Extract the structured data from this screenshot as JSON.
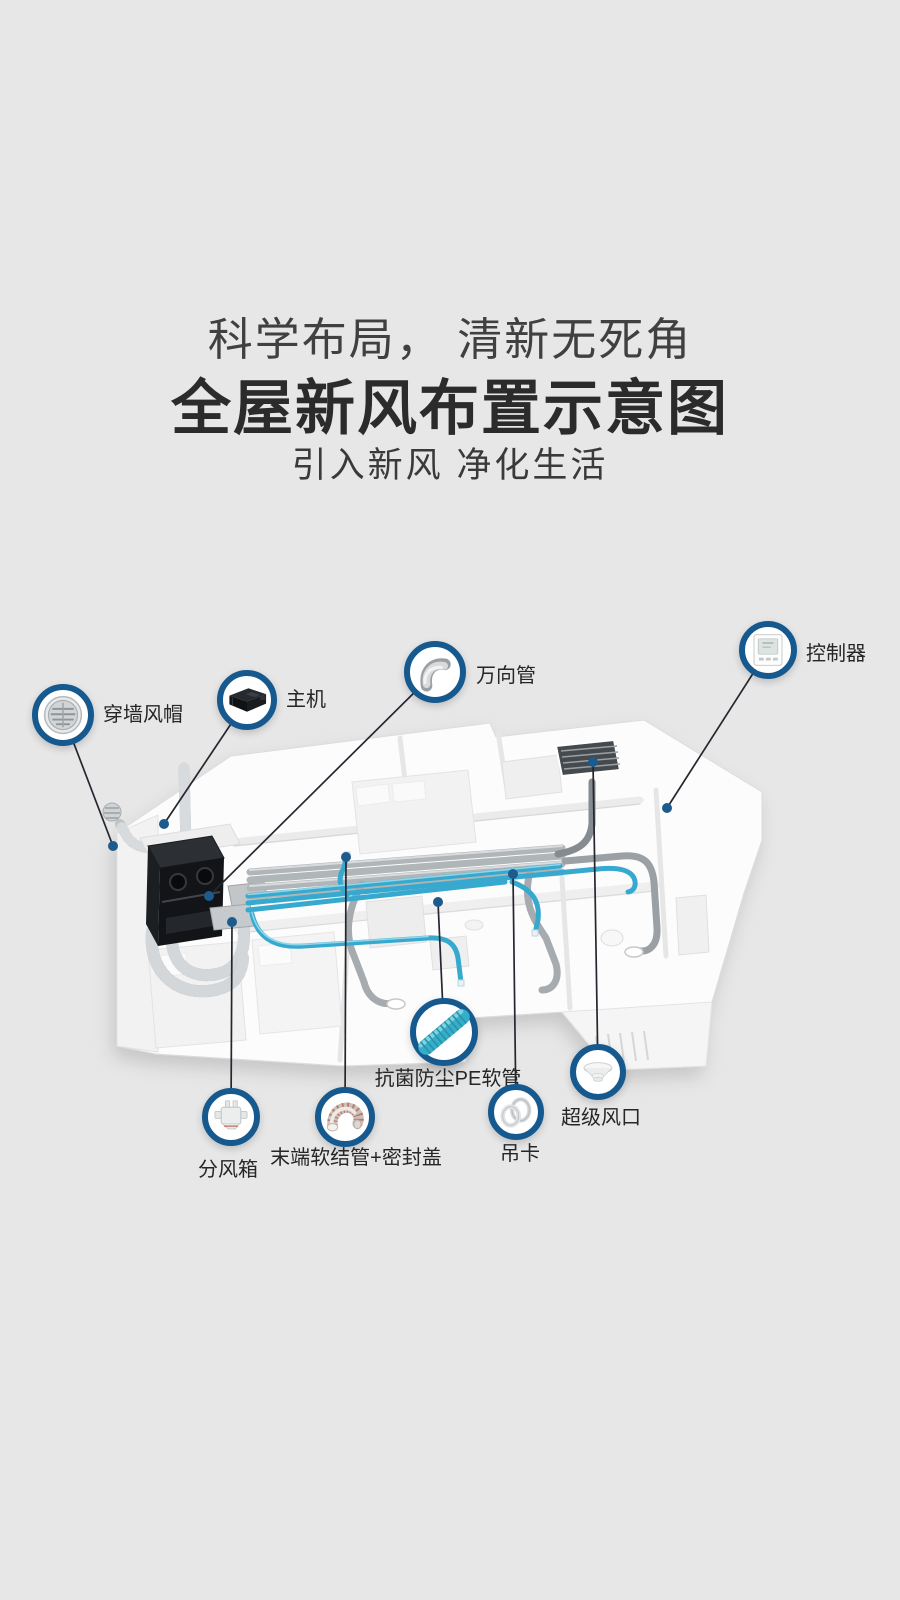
{
  "page": {
    "width": 900,
    "height": 1600,
    "background": "#e7e7e7"
  },
  "header": {
    "tagline": "科学布局， 清新无死角",
    "title": "全屋新风布置示意图",
    "subtitle": "引入新风  净化生活"
  },
  "colors": {
    "accent_blue": "#15598f",
    "leader_dot_blue": "#1d5b8d",
    "pipe_blue": "#38a9ce",
    "duct_gray": "#b0b5b8",
    "text_dark": "#2f2f2f",
    "background": "#e7e7e7"
  },
  "diagram": {
    "callouts": [
      {
        "id": "wall-cap",
        "label": "穿墙风帽",
        "icon": "wall-vent-cap-icon",
        "cx": 63,
        "cy": 715,
        "r": 31,
        "dot": [
          113,
          846
        ],
        "label_x": 103,
        "label_y": 715,
        "align": "left"
      },
      {
        "id": "main-unit",
        "label": "主机",
        "icon": "main-unit-icon",
        "cx": 247,
        "cy": 700,
        "r": 30,
        "dot": [
          164,
          824
        ],
        "label_x": 286,
        "label_y": 700,
        "align": "left"
      },
      {
        "id": "universal-pipe",
        "label": "万向管",
        "icon": "elbow-pipe-icon",
        "cx": 435,
        "cy": 672,
        "r": 31,
        "dot": [
          209,
          896
        ],
        "label_x": 476,
        "label_y": 676,
        "align": "left"
      },
      {
        "id": "controller",
        "label": "控制器",
        "icon": "controller-icon",
        "cx": 768,
        "cy": 650,
        "r": 29,
        "dot": [
          667,
          808
        ],
        "label_x": 806,
        "label_y": 654,
        "align": "left"
      },
      {
        "id": "pe-pipe",
        "label": "抗菌防尘PE软管",
        "icon": "pe-pipe-icon",
        "cx": 444,
        "cy": 1032,
        "r": 34,
        "dot": [
          438,
          902
        ],
        "label_x": 448,
        "label_y": 1079,
        "align": "center"
      },
      {
        "id": "end-hose",
        "label": "末端软结管+密封盖",
        "icon": "end-hose-icon",
        "cx": 345,
        "cy": 1117,
        "r": 30,
        "dot": [
          346,
          857
        ],
        "label_x": 356,
        "label_y": 1158,
        "align": "center"
      },
      {
        "id": "air-box",
        "label": "分风箱",
        "icon": "air-distribution-box-icon",
        "cx": 231,
        "cy": 1117,
        "r": 29,
        "dot": [
          232,
          922
        ],
        "label_x": 228,
        "label_y": 1170,
        "align": "center"
      },
      {
        "id": "hanging-clip",
        "label": "吊卡",
        "icon": "hanging-clip-icon",
        "cx": 516,
        "cy": 1112,
        "r": 28,
        "dot": [
          513,
          874
        ],
        "label_x": 520,
        "label_y": 1154,
        "align": "center"
      },
      {
        "id": "super-outlet",
        "label": "超级风口",
        "icon": "ceiling-outlet-icon",
        "cx": 598,
        "cy": 1072,
        "r": 28,
        "dot": [
          593,
          762
        ],
        "label_x": 601,
        "label_y": 1118,
        "align": "center"
      }
    ]
  }
}
